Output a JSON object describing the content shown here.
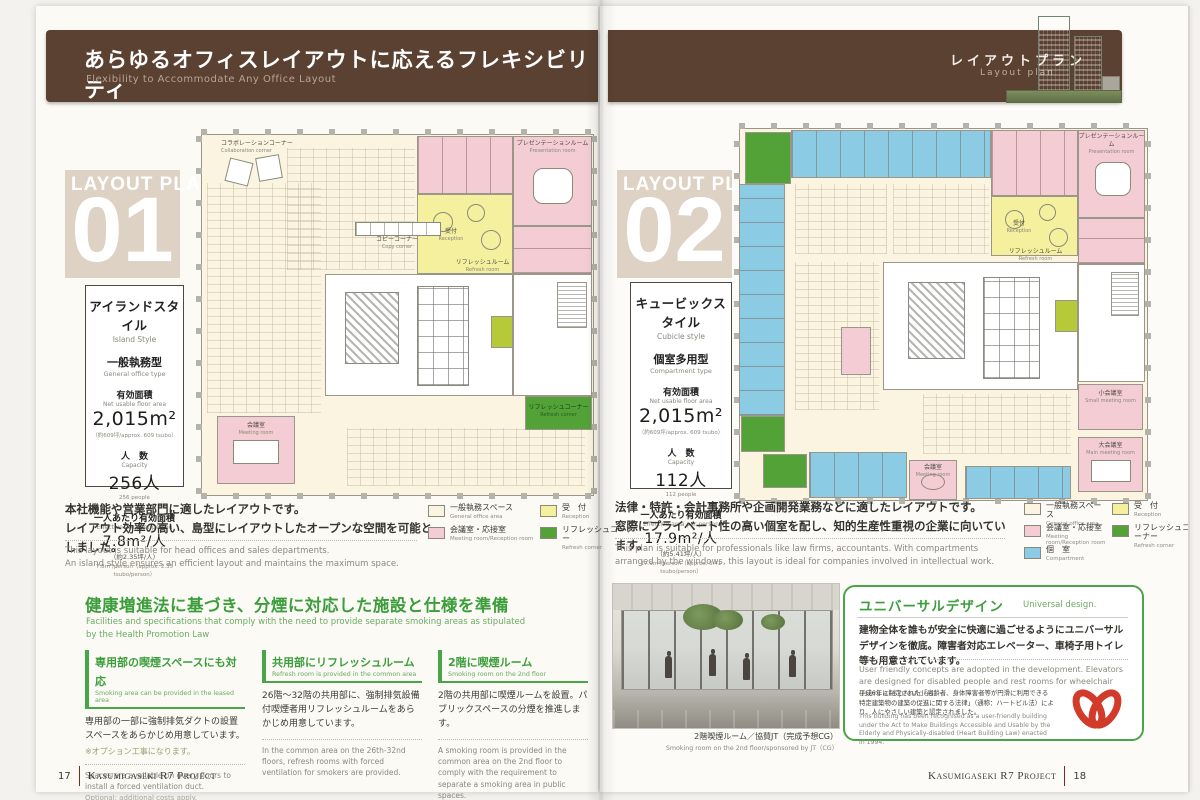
{
  "header": {
    "title_jp": "あらゆるオフィスレイアウトに応えるフレキシビリティ",
    "title_en": "Flexibility to Accommodate Any Office Layout",
    "tab_jp": "レイアウトプラン",
    "tab_en": "Layout plan"
  },
  "plan1": {
    "watermark": "LAYOUT PLAN",
    "number": "01",
    "style_jp": "アイランドスタイル",
    "style_en": "Island Style",
    "type_jp": "一般執務型",
    "type_en": "General office type",
    "area_label_jp": "有効面積",
    "area_label_en": "Net usable floor area",
    "area_value": "2,015m²",
    "area_note": "（約609坪/approx. 609 tsubo）",
    "capacity_label_jp": "人　数",
    "capacity_label_en": "Capacity",
    "capacity_value": "256人",
    "capacity_note": "256 people",
    "per_label_jp": "一人あたり有効面積",
    "per_label_en": "Effective area per person",
    "per_value": "7.8m²/人",
    "per_note_jp": "（約2.35坪/人）",
    "per_note_en": "7.8m²/person（approx. 2.35 tsubo/person）",
    "desc_jp1": "本社機能や営業部門に適したレイアウトです。",
    "desc_jp2": "レイアウト効率の高い、島型にレイアウトしたオープンな空間を可能としました。",
    "desc_en1": "This layout is suitable for head offices and sales departments.",
    "desc_en2": "An island style ensures an efficient layout and maintains the maximum space.",
    "legend": [
      {
        "jp": "一般執務スペース",
        "en": "General office area",
        "color": "#fbf4e0"
      },
      {
        "jp": "会議室・応接室",
        "en": "Meeting room/Reception room",
        "color": "#f4cdd4"
      },
      {
        "jp": "受　付",
        "en": "Reception",
        "color": "#f4f09e"
      },
      {
        "jp": "リフレッシュコーナー",
        "en": "Refresh corner",
        "color": "#53a238"
      }
    ],
    "labels": {
      "collaboration_jp": "コラボレーションコーナー",
      "collaboration_en": "Collaboration corner",
      "presentation_jp": "プレゼンテーションルーム",
      "presentation_en": "Presentation room",
      "reception_jp": "受付",
      "reception_en": "Reception",
      "refresh_room_jp": "リフレッシュルーム",
      "refresh_room_en": "Refresh room",
      "copy_jp": "コピーコーナー",
      "copy_en": "Copy corner",
      "meeting_jp": "会議室",
      "meeting_en": "Meeting room",
      "refresh_corner_jp": "リフレッシュコーナー",
      "refresh_corner_en": "Refresh corner"
    }
  },
  "plan2": {
    "watermark": "LAYOUT PLAN",
    "number": "02",
    "style_jp": "キュービックスタイル",
    "style_en": "Cubicle style",
    "type_jp": "個室多用型",
    "type_en": "Compartment type",
    "area_label_jp": "有効面積",
    "area_label_en": "Net usable floor area",
    "area_value": "2,015m²",
    "area_note": "（約609坪/approx. 609 tsubo）",
    "capacity_label_jp": "人　数",
    "capacity_label_en": "Capacity",
    "capacity_value": "112人",
    "capacity_note": "112 people",
    "per_label_jp": "一人あたり有効面積",
    "per_label_en": "Effective area per person",
    "per_value": "17.9m²/人",
    "per_note_jp": "（約5.41坪/人）",
    "per_note_en": "17.9m²/person（approx. 5.41 tsubo/person）",
    "desc_jp1": "法律・特許・会計事務所や企画開発業務などに適したレイアウトです。",
    "desc_jp2": "窓際にプライベート性の高い個室を配し、知的生産性重視の企業に向いています。",
    "desc_en1": "This plan is suitable for professionals like law firms, accountants. With compartments",
    "desc_en2": "arranged by the windows, this layout is ideal for companies involved in intellectual work.",
    "legend": [
      {
        "jp": "一般執務スペース",
        "en": "General office area",
        "color": "#fbf4e0"
      },
      {
        "jp": "会議室・応接室",
        "en": "Meeting room/Reception room",
        "color": "#f4cdd4"
      },
      {
        "jp": "個　室",
        "en": "Compartment",
        "color": "#8ccbe4"
      },
      {
        "jp": "受　付",
        "en": "Reception",
        "color": "#f4f09e"
      },
      {
        "jp": "リフレッシュコーナー",
        "en": "Refresh corner",
        "color": "#53a238"
      }
    ],
    "labels": {
      "presentation_jp": "プレゼンテーションルーム",
      "presentation_en": "Presentation room",
      "reception_jp": "受付",
      "reception_en": "Reception",
      "refresh_room_jp": "リフレッシュルーム",
      "refresh_room_en": "Refresh room",
      "small_meeting_jp": "小会議室",
      "small_meeting_en": "Small meeting room",
      "main_meeting_jp": "大会議室",
      "main_meeting_en": "Main meeting room",
      "meeting_jp": "会議室",
      "meeting_en": "Meeting room"
    }
  },
  "smoking": {
    "heading_jp": "健康増進法に基づき、分煙に対応した施設と仕様を準備",
    "heading_en": "Facilities and specifications that comply with the need to provide separate smoking areas as stipulated by the Health Promotion Law",
    "columns": [
      {
        "title_jp": "専用部の喫煙スペースにも対応",
        "title_en": "Smoking area can be provided in the leased area",
        "body_jp": "専用部の一部に強制排気ダクトの設置スペースをあらかじめ用意しています。",
        "note_jp": "※オプション工事になります。",
        "body_en": "Spaces are available on every floors to install a forced ventilation duct.",
        "note_en": "Optional: additional costs apply."
      },
      {
        "title_jp": "共用部にリフレッシュルーム",
        "title_en": "Refresh room is provided in the common area",
        "body_jp": "26階～32階の共用部に、強制排気設備付喫煙者用リフレッシュルームをあらかじめ用意しています。",
        "body_en": "In the common area on the 26th-32nd floors, refresh rooms with forced ventilation for smokers are provided."
      },
      {
        "title_jp": "2階に喫煙ルーム",
        "title_en": "Smoking room on the 2nd floor",
        "body_jp": "2階の共用部に喫煙ルームを設置。パブリックスペースの分煙を推進します。",
        "body_en": "A smoking room is provided in the common area on the 2nd floor to comply with the requirement to separate a smoking area in public spaces."
      }
    ]
  },
  "photo": {
    "caption_jp": "2階喫煙ルーム／協賛JT（完成予想CG）",
    "caption_en": "Smoking room on the 2nd floor/sponsored by JT（CG）"
  },
  "universal": {
    "title_jp": "ユニバーサルデザイン",
    "title_en": "Universal design.",
    "body_jp": "建物全体を誰もが安全に快適に過ごせるようにユニバーサルデザインを徹底。障害者対応エレベーター、車椅子用トイレ等も用意されています。",
    "body_en": "User friendly concepts are adopted in the development. Elevators are designed for disabled people and rest rooms for wheelchair users are provided.",
    "note_jp": "平成6年に制定された「高齢者、身体障害者等が円滑に利用できる特定建築物の建築の促進に関する法律」（通称：ハートビル法）により、人にやさしい建築と認定されました。",
    "note_en": "This building has been recognised as a user-friendly building under the Act to Make Buildings Accessible and Usable by the Elderly and Physically-disabled (Heart Building Law) enacted in 1994."
  },
  "footer": {
    "page_left": "17",
    "page_right": "18",
    "project_left": "Kasumigaseki R7 Project",
    "project_right": "Kasumigaseki R7 Project"
  }
}
